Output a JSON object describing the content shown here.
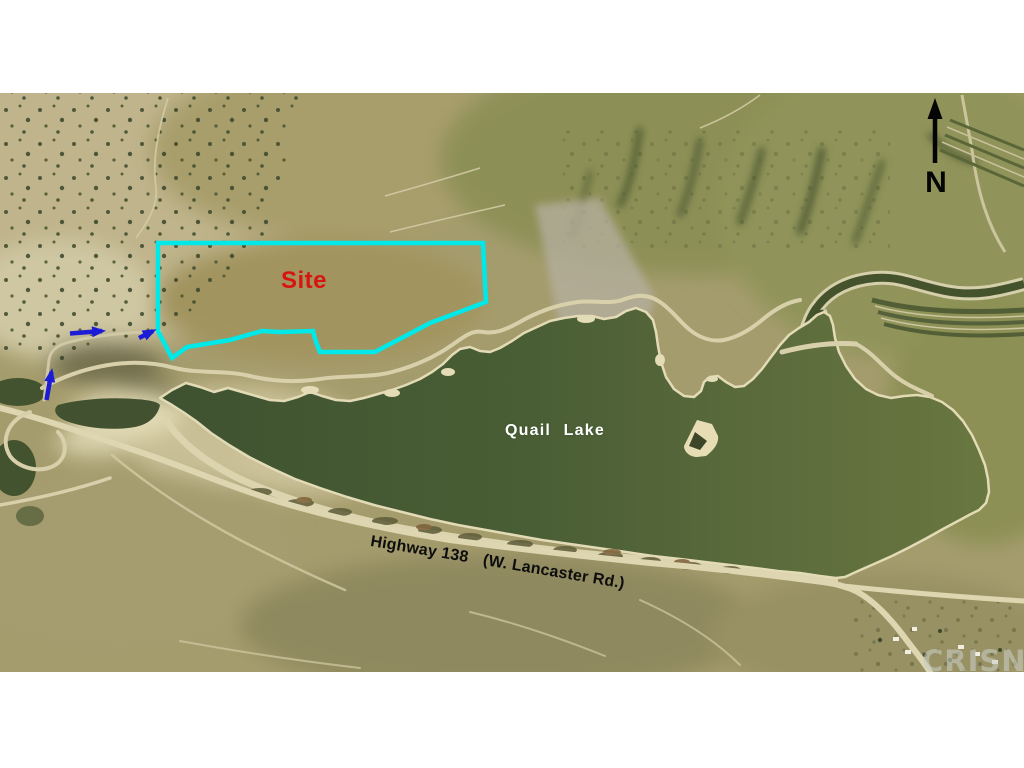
{
  "map": {
    "site": {
      "label": "Site",
      "outline_color": "#00e8e8",
      "label_color": "#d81410"
    },
    "lake": {
      "label": "Quail Lake",
      "water_color": "#4a5c33",
      "label_color": "#ffffff"
    },
    "highway": {
      "label": "Highway 138",
      "sublabel": "(W. Lancaster Rd.)",
      "label_color": "#0d0d0d"
    },
    "compass": {
      "label": "N",
      "arrow_color": "#000000"
    },
    "watermark": {
      "label": "CRISNET",
      "color": "#c9ccc5"
    },
    "route_arrows": {
      "count": 3,
      "color": "#1c1cd6"
    }
  }
}
